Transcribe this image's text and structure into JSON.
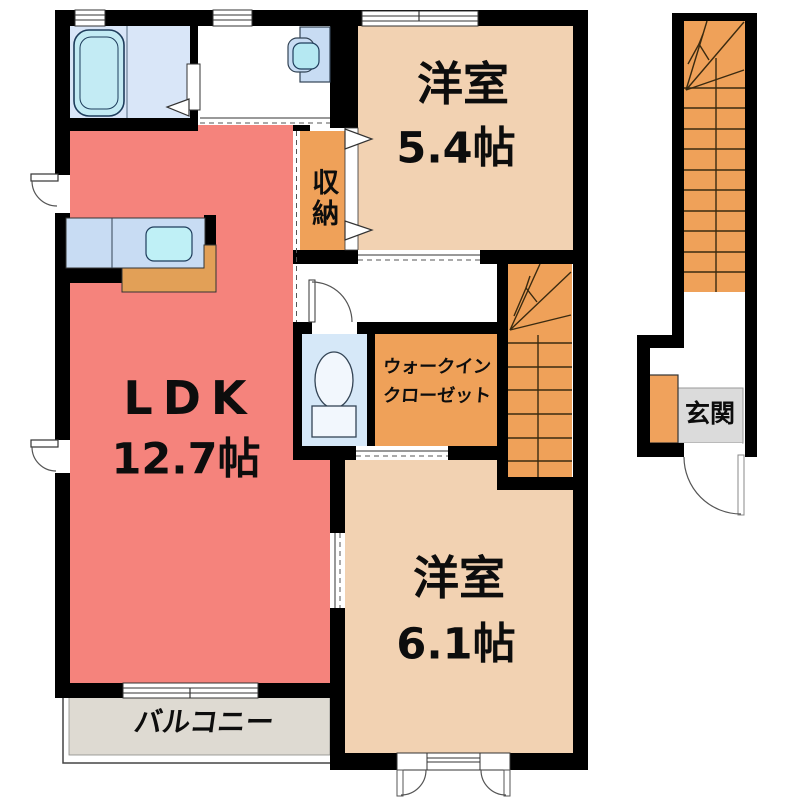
{
  "floorplan_title": "2F apartment floor plan",
  "rooms": {
    "bedroom1": {
      "label": "洋室",
      "size": "5.4帖"
    },
    "ldk": {
      "label": "LDK",
      "size": "12.7帖"
    },
    "bedroom2": {
      "label": "洋室",
      "size": "6.1帖"
    },
    "storage": {
      "label": "収納"
    },
    "walk_in_closet": {
      "line1": "ウォークイン",
      "line2": "クローゼット"
    },
    "balcony": {
      "label": "バルコニー"
    },
    "entrance": {
      "label": "玄関"
    }
  },
  "fixtures": [
    "bathtub",
    "washbasin",
    "kitchen-sink",
    "toilet",
    "stairs-main",
    "stairs-entrance",
    "shoe-cabinet"
  ],
  "colors": {
    "wall": "#000000",
    "ldk": "#F5837C",
    "bedroom": "#F2D2B2",
    "closet": "#EFA159",
    "stairs": "#EFA159",
    "counter_front": "#E2A057",
    "shoe_cabinet": "#F0A25C",
    "balcony": "#DEDAD2",
    "genkan_floor": "#DBDBDB",
    "bath_floor": "#D9E6F8",
    "toilet_floor": "#D6E8F8",
    "fixture_blue": "#C8DCF3",
    "tub": "#C3EBF4",
    "bowl_cyan": "#B5E8F2",
    "sink_cyan": "#BFF0F6",
    "toilet_white": "#F2F7FD",
    "line_dark": "#333333"
  }
}
